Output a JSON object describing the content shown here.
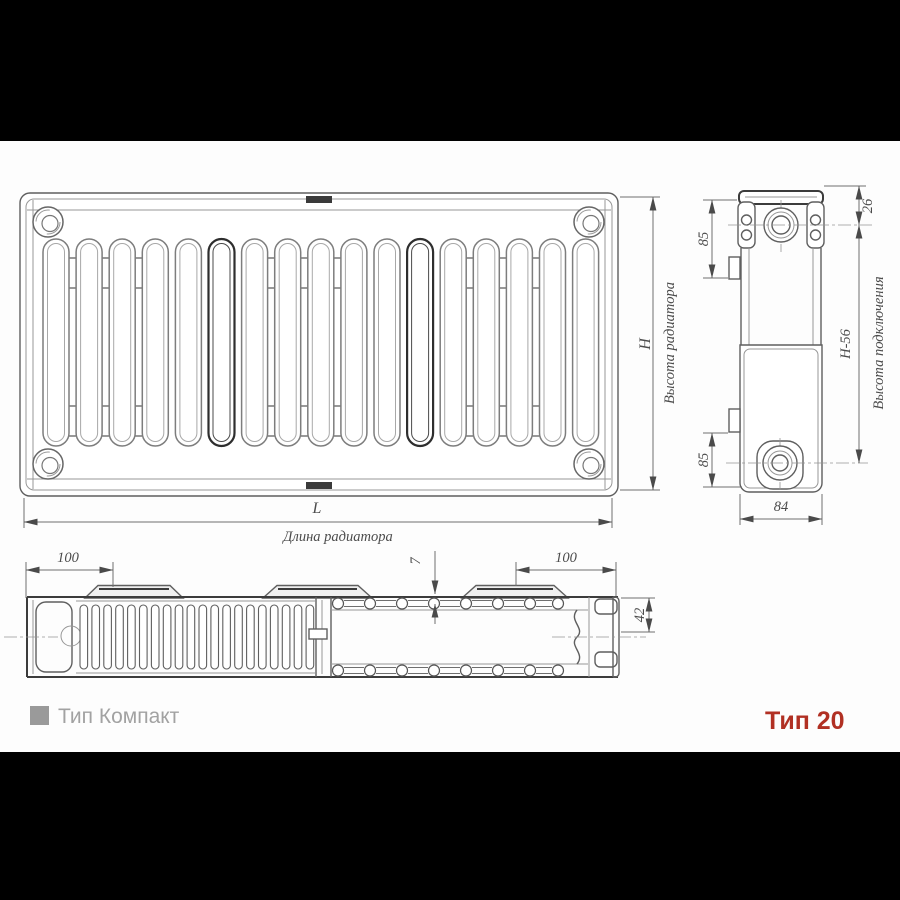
{
  "legend": {
    "series_label": "Тип Компакт",
    "type_label": "Тип 20"
  },
  "front_view": {
    "height_symbol": "H",
    "height_name": "Высота радиатора",
    "length_symbol": "L",
    "length_name": "Длина радиатора"
  },
  "side_view": {
    "top_port_offset": "26",
    "bracket_top_offset": "85",
    "bracket_bottom_offset": "85",
    "connection_height_value": "H-56",
    "connection_height_name": "Высота подключения",
    "depth": "84"
  },
  "top_view": {
    "bracket_inset_left": "100",
    "bracket_inset_right": "100",
    "panel_gap": "7",
    "end_spacing": "42"
  },
  "colors": {
    "accent_red": "#b13023",
    "legend_gray": "#a2a2a2",
    "drawing_line": "#5f5f5f",
    "letterbox": "#000000"
  }
}
